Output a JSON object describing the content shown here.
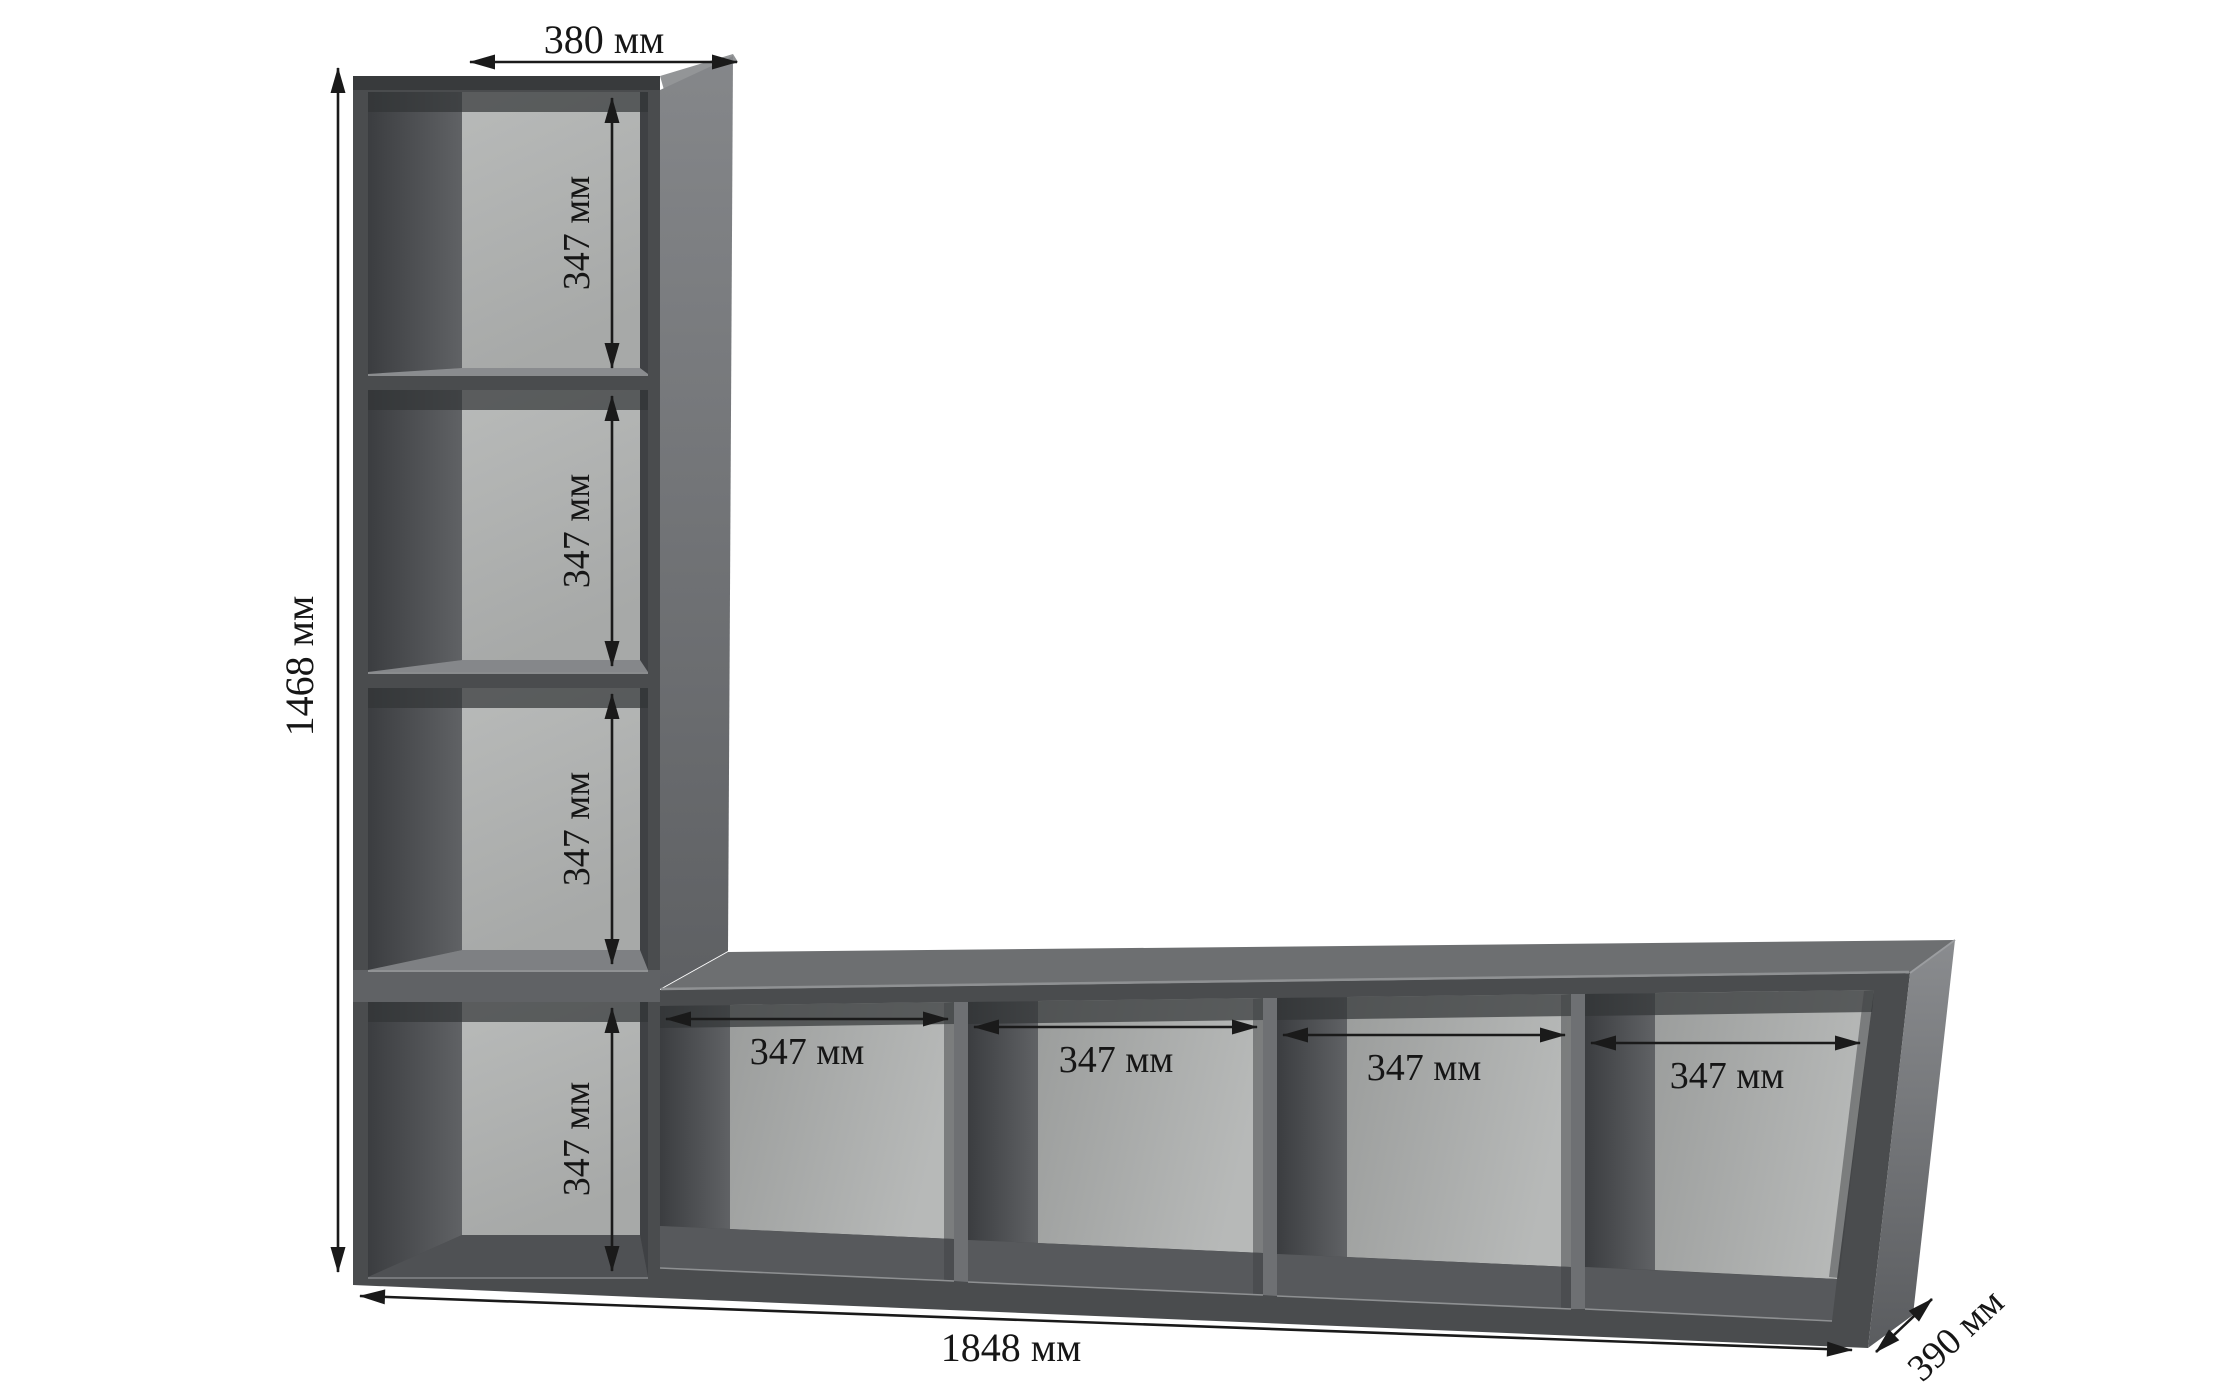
{
  "meta": {
    "type": "furniture-dimension-diagram",
    "subject": "L-shaped cube shelving unit",
    "units": "мм"
  },
  "diagram": {
    "dim_top_width": "380 мм",
    "dim_total_height": "1468 мм",
    "dim_total_width": "1848 мм",
    "dim_depth": "390 мм",
    "column_cells": [
      "347 мм",
      "347 мм",
      "347 мм",
      "347 мм"
    ],
    "row_cells": [
      "347 мм",
      "347 мм",
      "347 мм",
      "347 мм"
    ],
    "values_mm": {
      "total_width": 1848,
      "total_height": 1468,
      "depth": 390,
      "column_top_width": 380,
      "cell_size": 347
    },
    "colors": {
      "background": "#ffffff",
      "front_face": "#4a4c4e",
      "top_face": "#6d6f71",
      "side_face": "#7d7f82",
      "back_panel": "#b2b4b3",
      "dimension_ink": "#1a1a1a"
    }
  }
}
